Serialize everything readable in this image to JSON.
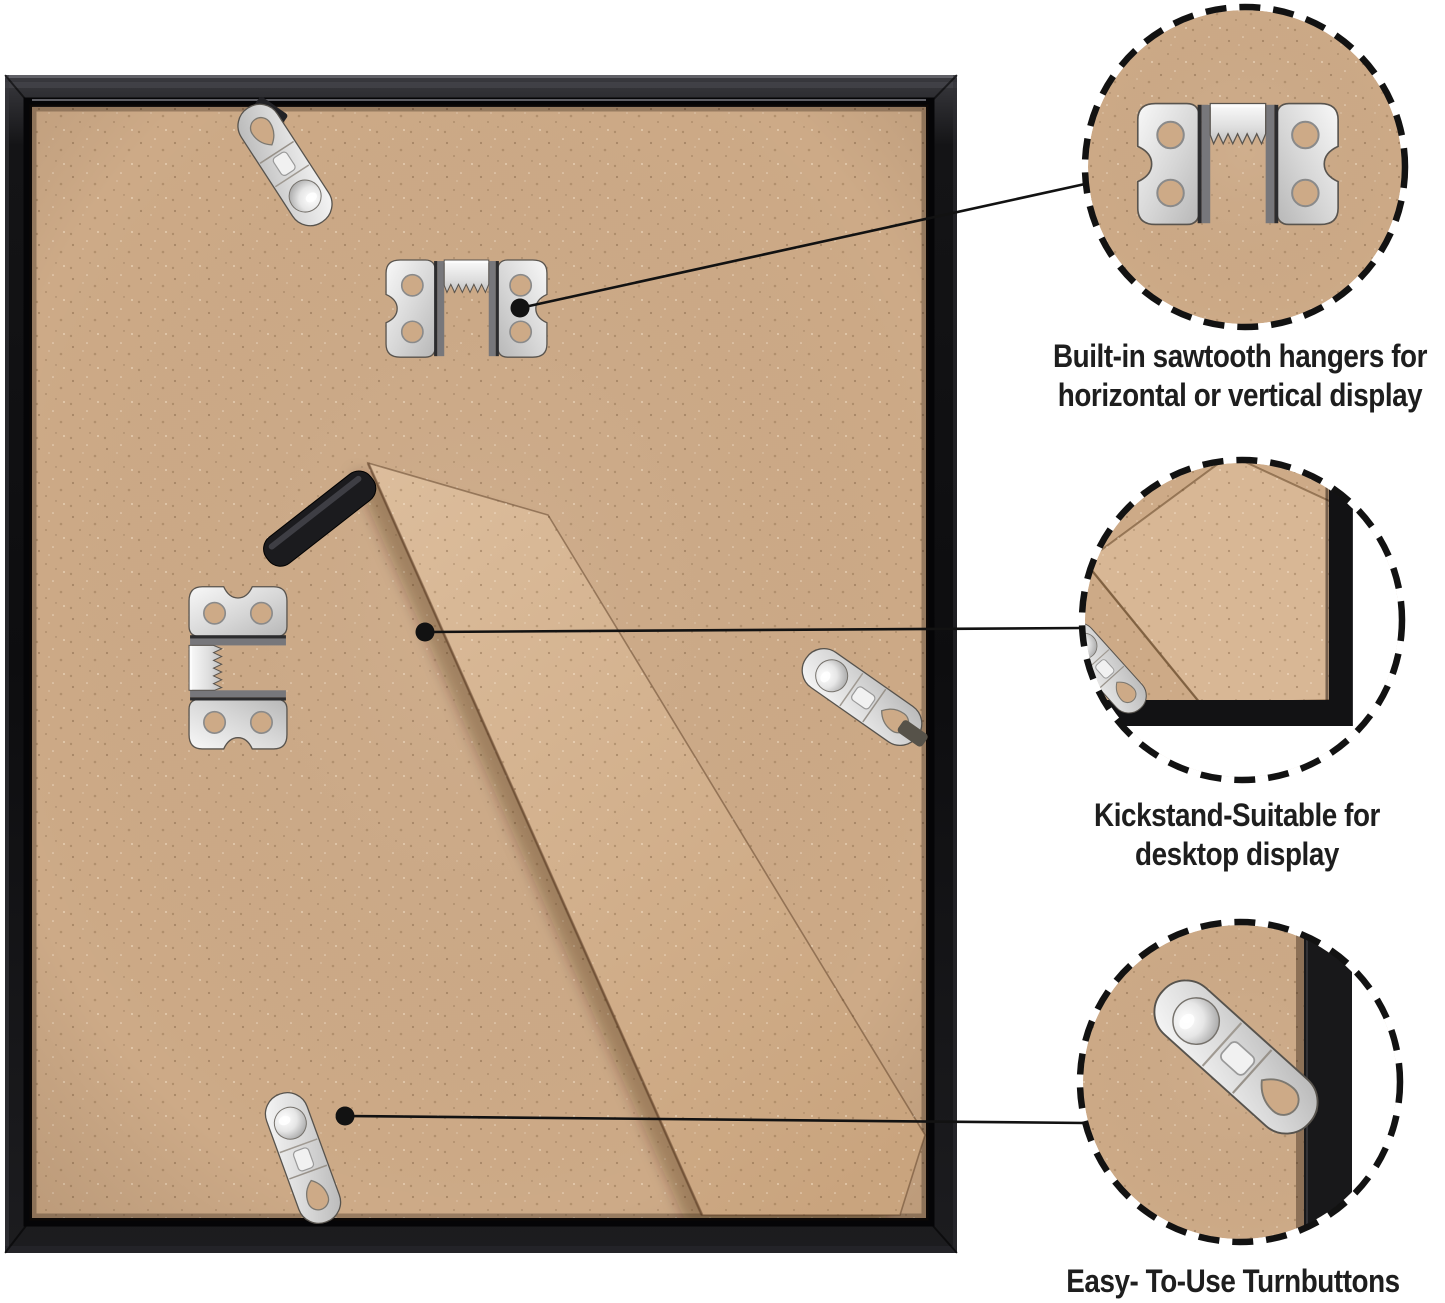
{
  "image_type": "product feature callout diagram",
  "subject": "back of a black picture frame with mounting hardware",
  "colors": {
    "background": "#ffffff",
    "mdf_tan": "#cdaa87",
    "mdf_tan_light": "#d8b795",
    "frame_black": "#141416",
    "hinge_black": "#1b1b1e",
    "metal_silver": "#e9e9e9",
    "callout": "#121212",
    "text": "#1e1e1e"
  },
  "callouts": [
    {
      "id": "sawtooth-hangers",
      "line1": "Built-in sawtooth hangers for",
      "line2": "horizontal or vertical display"
    },
    {
      "id": "kickstand",
      "line1": "Kickstand-Suitable for",
      "line2": "desktop display"
    },
    {
      "id": "turnbuttons",
      "line1": "Easy- To-Use Turnbuttons",
      "line2": ""
    }
  ],
  "hardware_icons": [
    "sawtooth-hanger-icon",
    "turnbutton-icon",
    "kickstand-icon"
  ]
}
